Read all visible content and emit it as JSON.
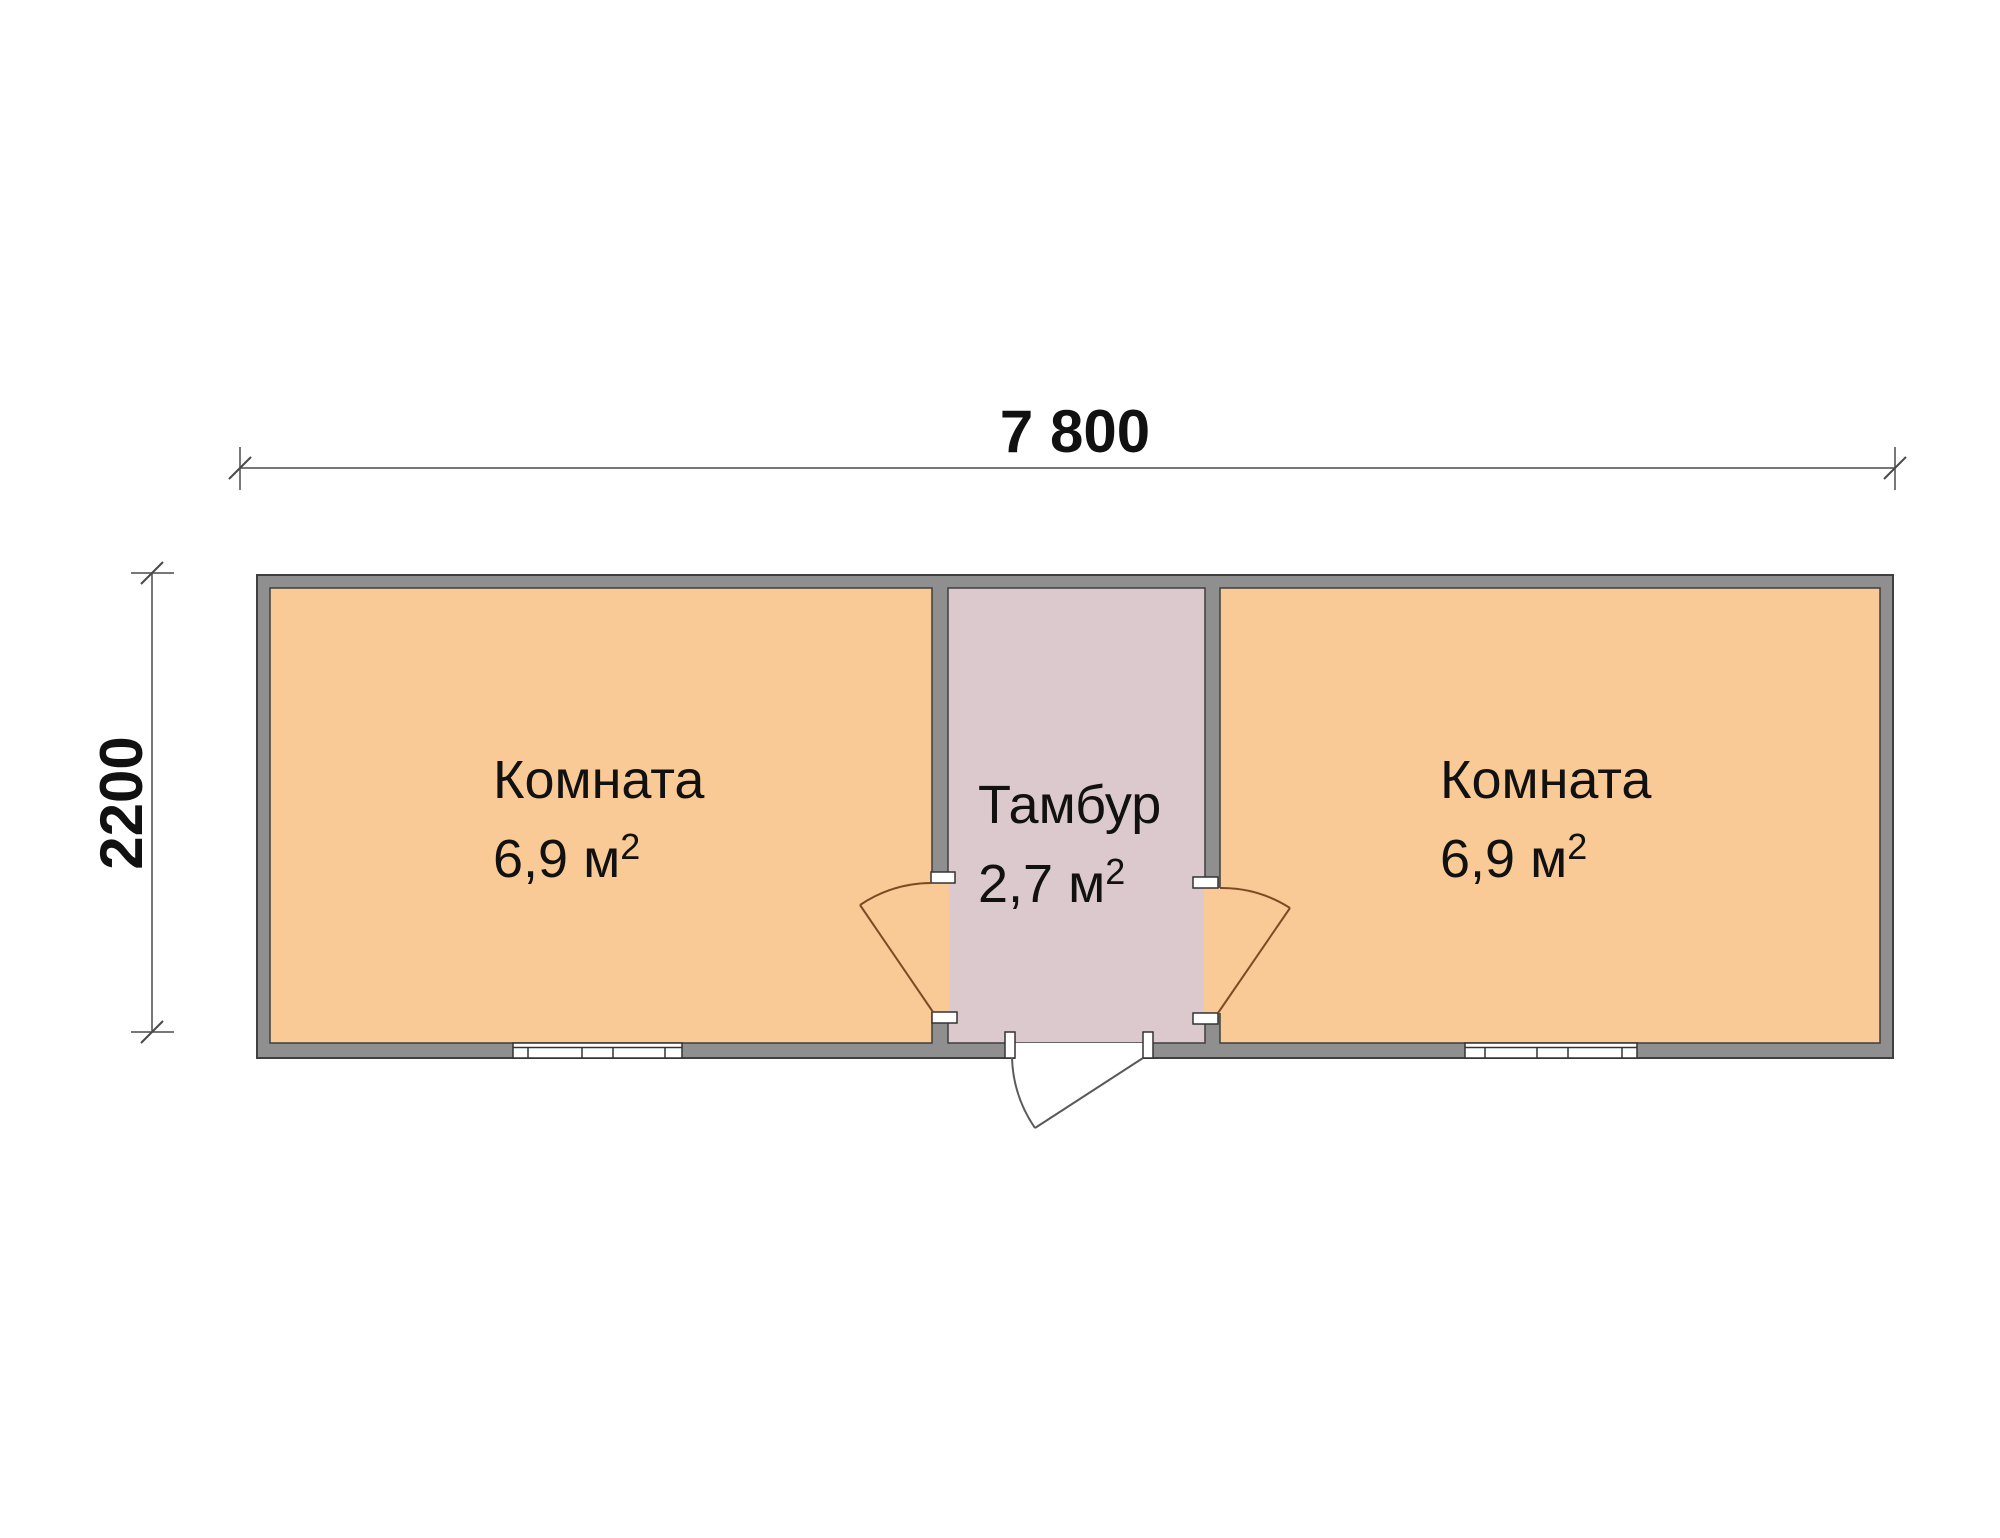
{
  "plan": {
    "dim_width": "7 800",
    "dim_height": "2200",
    "room_left": {
      "name": "Комната",
      "area": "6,9 м",
      "sup": "2"
    },
    "tambour": {
      "name": "Тамбур",
      "area": "2,7 м",
      "sup": "2"
    },
    "room_right": {
      "name": "Комната",
      "area": "6,9 м",
      "sup": "2"
    }
  },
  "colors": {
    "background": "#ffffff",
    "room_fill": "#f9ca95",
    "tambour_fill": "#dbc9ce",
    "wall_fill": "#8f8f8f",
    "wall_line": "#3f3f3f",
    "jamb_fill": "#ffffff",
    "window_line": "#333333",
    "door_interior": "#7c4b24",
    "door_exterior": "#5a5a5a",
    "dim_line": "#4a4a4a",
    "text_color": "#111111"
  }
}
